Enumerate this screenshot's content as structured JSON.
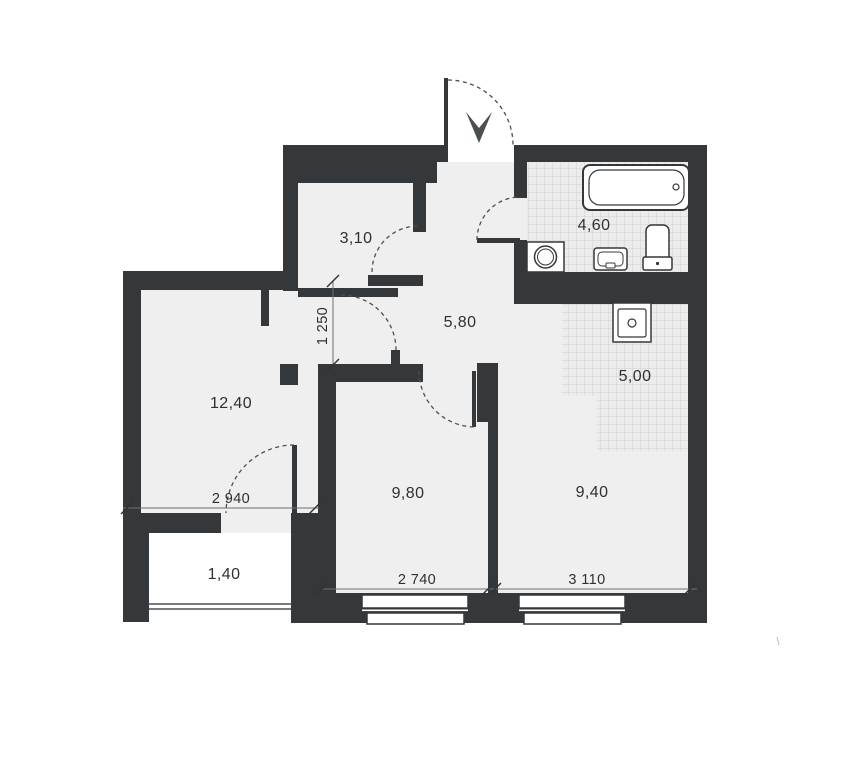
{
  "rooms": {
    "hall_closet": {
      "label": "3,10"
    },
    "bathroom": {
      "label": "4,60"
    },
    "hallway": {
      "label": "5,80"
    },
    "kitchen_zone": {
      "label": "5,00"
    },
    "living_room": {
      "label": "12,40"
    },
    "bedroom": {
      "label": "9,80"
    },
    "kitchen_room": {
      "label": "9,40"
    },
    "balcony": {
      "label": "1,40"
    }
  },
  "dimensions": {
    "opening_height": {
      "label": "1 250"
    },
    "living_room_width": {
      "label": "2 940"
    },
    "bedroom_width": {
      "label": "2 740"
    },
    "kitchen_room_width": {
      "label": "3 110"
    }
  },
  "fixtures": [
    "bathtub",
    "washing-machine",
    "sink",
    "toilet",
    "kitchen-sink"
  ],
  "colors": {
    "wall": "#34383b",
    "floor": "#efefef",
    "tile_line": "#c9c9c9",
    "tile_bg": "#ececec",
    "line": "#4e4e4e",
    "text": "#2c3033"
  }
}
